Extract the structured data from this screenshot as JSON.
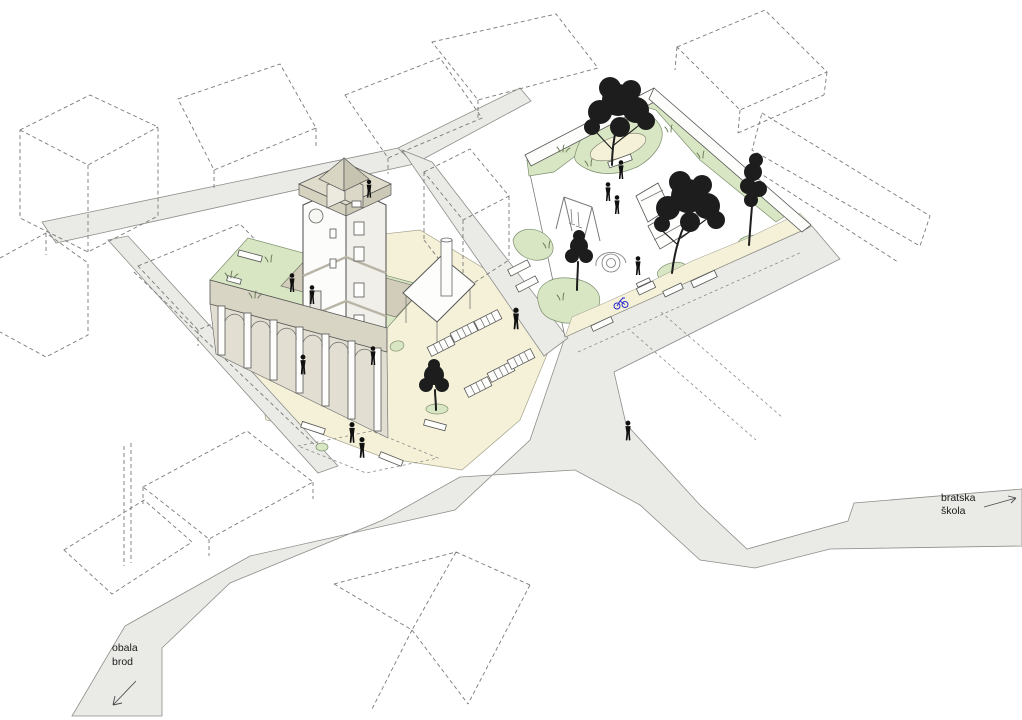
{
  "diagram": {
    "type": "axonometric site plan",
    "labels": {
      "street_right_line1": "bratska",
      "street_right_line2": "škola",
      "street_left_line1": "obala",
      "street_left_line2": "brod"
    },
    "colors": {
      "paper": "#ffffff",
      "road": "#eaeae7",
      "plaza": "#f4f1d8",
      "lawn": "#d8e6c4",
      "wall": "#d9d5c4",
      "terrace": "#d2cdbb",
      "parapet": "#e0dccb",
      "tree": "#1d1d1d",
      "figure": "#101010",
      "bike": "#2a2ace"
    },
    "features": {
      "people_count": 12,
      "trees_count": 5,
      "loungers_count": 6,
      "tower": "four-storey tower with rooftop lantern",
      "arcade": "colonnade wing with green roof and terrace",
      "playground": "paved square with lawn edge, swing and climbing frames",
      "context": "surrounding buildings shown as dashed outlines"
    }
  }
}
